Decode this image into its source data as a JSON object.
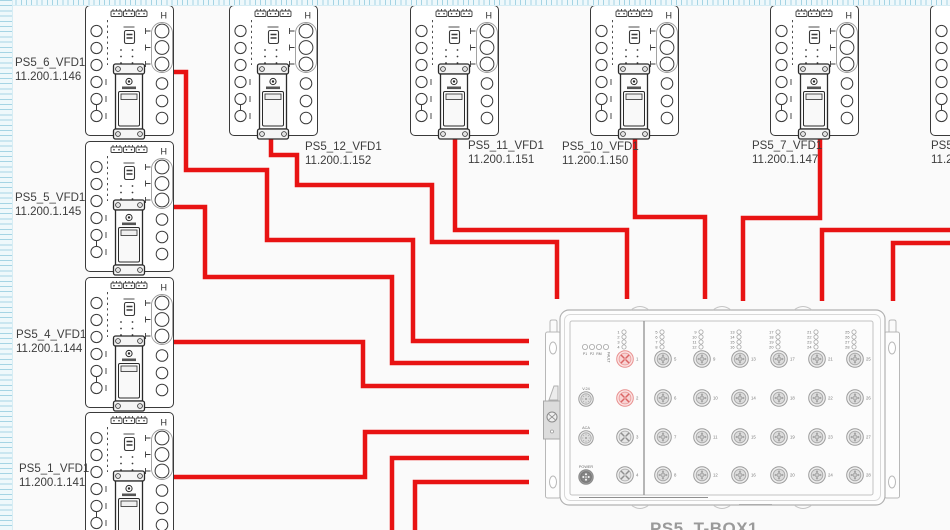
{
  "canvas": {
    "width": 950,
    "height": 530,
    "background": "#fafafa"
  },
  "cable_color": "#e81313",
  "vfd_symbol": {
    "h_mark": "H"
  },
  "devices": [
    {
      "name": "PS5_6_VFD1",
      "ip": "11.200.1.146",
      "x": 85,
      "y": 5,
      "label_x": 15,
      "label_y": 57
    },
    {
      "name": "PS5_5_VFD1",
      "ip": "11.200.1.145",
      "x": 85,
      "y": 141,
      "label_x": 15,
      "label_y": 192
    },
    {
      "name": "PS5_4_VFD1",
      "ip": "11.200.1.144",
      "x": 85,
      "y": 277,
      "label_x": 16,
      "label_y": 329
    },
    {
      "name": "PS5_1_VFD1",
      "ip": "11.200.1.141",
      "x": 85,
      "y": 412,
      "label_x": 19,
      "label_y": 463
    },
    {
      "name": "PS5_12_VFD1",
      "ip": "11.200.1.152",
      "x": 229,
      "y": 5,
      "label_x": 305,
      "label_y": 141
    },
    {
      "name": "PS5_11_VFD1",
      "ip": "11.200.1.151",
      "x": 410,
      "y": 5,
      "label_x": 468,
      "label_y": 140
    },
    {
      "name": "PS5_10_VFD1",
      "ip": "11.200.1.150",
      "x": 590,
      "y": 5,
      "label_x": 562,
      "label_y": 141
    },
    {
      "name": "PS5_7_VFD1",
      "ip": "11.200.1.147",
      "x": 770,
      "y": 5,
      "label_x": 752,
      "label_y": 140
    },
    {
      "name": "PS5_8_VFD1",
      "ip": "11.200.1.148",
      "x": 930,
      "y": 5,
      "label_x": 931,
      "label_y": 140
    }
  ],
  "cables": [
    {
      "name": "cable-PS5_6",
      "points": [
        [
          173,
          72
        ],
        [
          186,
          72
        ],
        [
          186,
          170
        ],
        [
          267,
          170
        ],
        [
          267,
          240
        ],
        [
          413,
          240
        ],
        [
          413,
          341
        ],
        [
          529,
          341
        ]
      ]
    },
    {
      "name": "cable-PS5_5",
      "points": [
        [
          173,
          207
        ],
        [
          205,
          207
        ],
        [
          205,
          277
        ],
        [
          392,
          277
        ],
        [
          392,
          363
        ],
        [
          529,
          363
        ]
      ]
    },
    {
      "name": "cable-PS5_4",
      "points": [
        [
          173,
          342
        ],
        [
          363,
          342
        ],
        [
          363,
          386
        ],
        [
          529,
          386
        ]
      ]
    },
    {
      "name": "cable-PS5_1",
      "points": [
        [
          173,
          477
        ],
        [
          365,
          477
        ],
        [
          365,
          432
        ],
        [
          529,
          432
        ]
      ]
    },
    {
      "name": "cable-bottom-1",
      "points": [
        [
          392,
          532
        ],
        [
          392,
          458
        ],
        [
          529,
          458
        ]
      ]
    },
    {
      "name": "cable-bottom-2",
      "points": [
        [
          415,
          532
        ],
        [
          415,
          482
        ],
        [
          529,
          482
        ]
      ]
    },
    {
      "name": "cable-PS5_12",
      "points": [
        [
          271,
          139
        ],
        [
          271,
          155
        ],
        [
          297,
          155
        ],
        [
          297,
          185
        ],
        [
          432,
          185
        ],
        [
          432,
          242
        ],
        [
          557,
          242
        ],
        [
          557,
          299
        ]
      ]
    },
    {
      "name": "cable-PS5_11",
      "points": [
        [
          455,
          139
        ],
        [
          455,
          230
        ],
        [
          627,
          230
        ],
        [
          627,
          299
        ]
      ]
    },
    {
      "name": "cable-PS5_10",
      "points": [
        [
          635,
          139
        ],
        [
          635,
          217
        ],
        [
          705,
          217
        ],
        [
          705,
          299
        ]
      ]
    },
    {
      "name": "cable-PS5_7",
      "points": [
        [
          820,
          139
        ],
        [
          820,
          218
        ],
        [
          743,
          218
        ],
        [
          743,
          301
        ]
      ]
    },
    {
      "name": "cable-right-1",
      "points": [
        [
          952,
          230
        ],
        [
          822,
          230
        ],
        [
          822,
          301
        ]
      ]
    },
    {
      "name": "cable-right-2",
      "points": [
        [
          952,
          243
        ],
        [
          893,
          243
        ],
        [
          893,
          301
        ]
      ]
    }
  ],
  "switch": {
    "x": 543,
    "y": 301,
    "bottom_label": "PS5_T-BOX1",
    "status_leds": [
      "P1",
      "P2",
      "RM",
      "FAULT"
    ],
    "connectors": [
      {
        "label": "V.24",
        "style": "din"
      },
      {
        "label": "ACA",
        "style": "din"
      },
      {
        "label": "POWER",
        "style": "power"
      }
    ],
    "port_columns": [
      [
        1,
        2,
        3,
        4
      ],
      [
        5,
        6,
        7,
        8
      ],
      [
        9,
        10,
        11,
        12
      ],
      [
        13,
        14,
        15,
        16
      ],
      [
        17,
        18,
        19,
        20
      ],
      [
        21,
        22,
        23,
        24
      ],
      [
        25,
        26,
        27,
        28
      ]
    ],
    "highlighted_ports": [
      1,
      2
    ]
  }
}
